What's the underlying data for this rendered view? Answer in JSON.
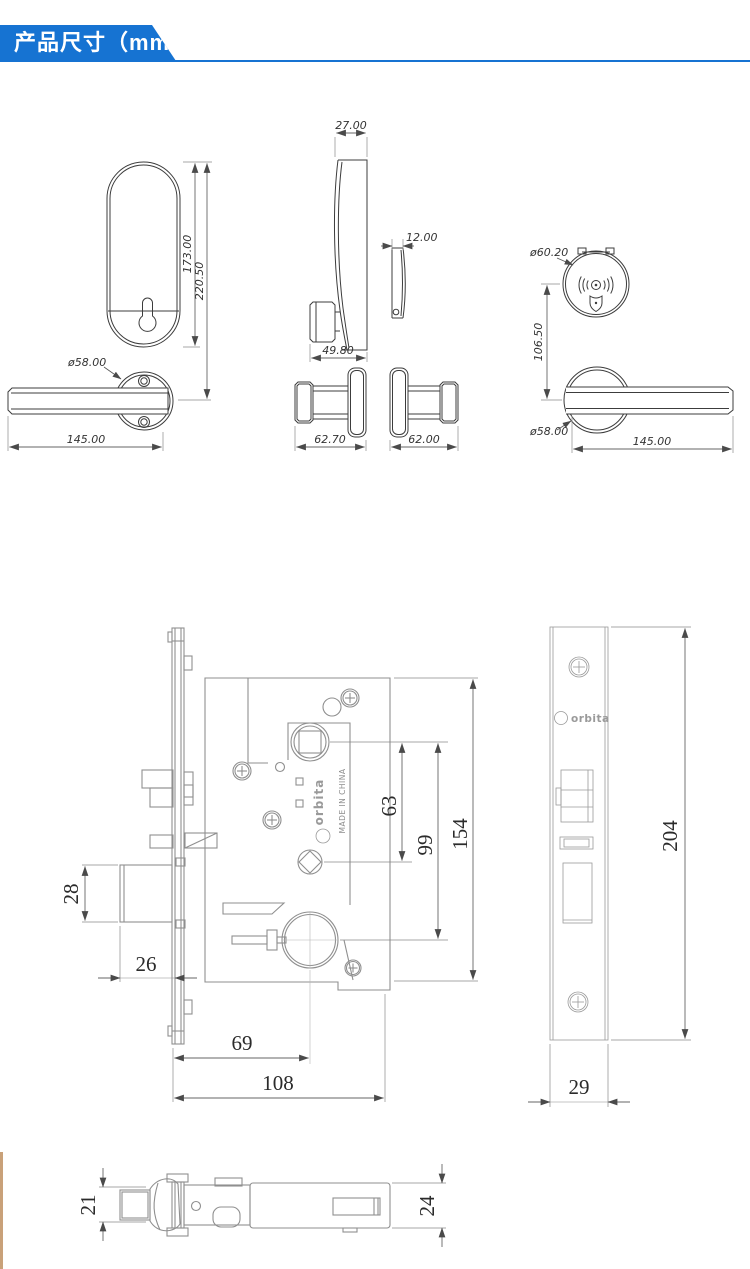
{
  "header": {
    "title": "产品尺寸（mm）"
  },
  "colors": {
    "accent": "#1673d2",
    "line_dark": "#3c3c3c",
    "line_gray": "#8f8f8f",
    "stripe_tan": "#c9a179"
  },
  "labels": {
    "escutcheon_height": "173.00",
    "escutcheon_total": "220.50",
    "ext_rose_dia": "ø58.00",
    "ext_handle_len": "145.00",
    "side_width": "27.00",
    "side_depth": "49.80",
    "thin_width": "12.00",
    "side_left_depth": "62.70",
    "side_right_depth": "62.00",
    "reader_dia": "ø60.20",
    "reader_offset": "106.50",
    "int_rose_dia": "ø58.00",
    "int_handle_len": "145.00",
    "deadbolt_h": "28",
    "front_backset": "26",
    "cyl_backset": "69",
    "body_width": "108",
    "hub_spacing": "63",
    "hub_cyl": "99",
    "body_height": "154",
    "plate_height": "204",
    "plate_width": "29",
    "latch_h": "21",
    "case_h": "24",
    "brand": "orbita",
    "brand_plate": "orbita",
    "origin": "MADE IN CHINA"
  }
}
